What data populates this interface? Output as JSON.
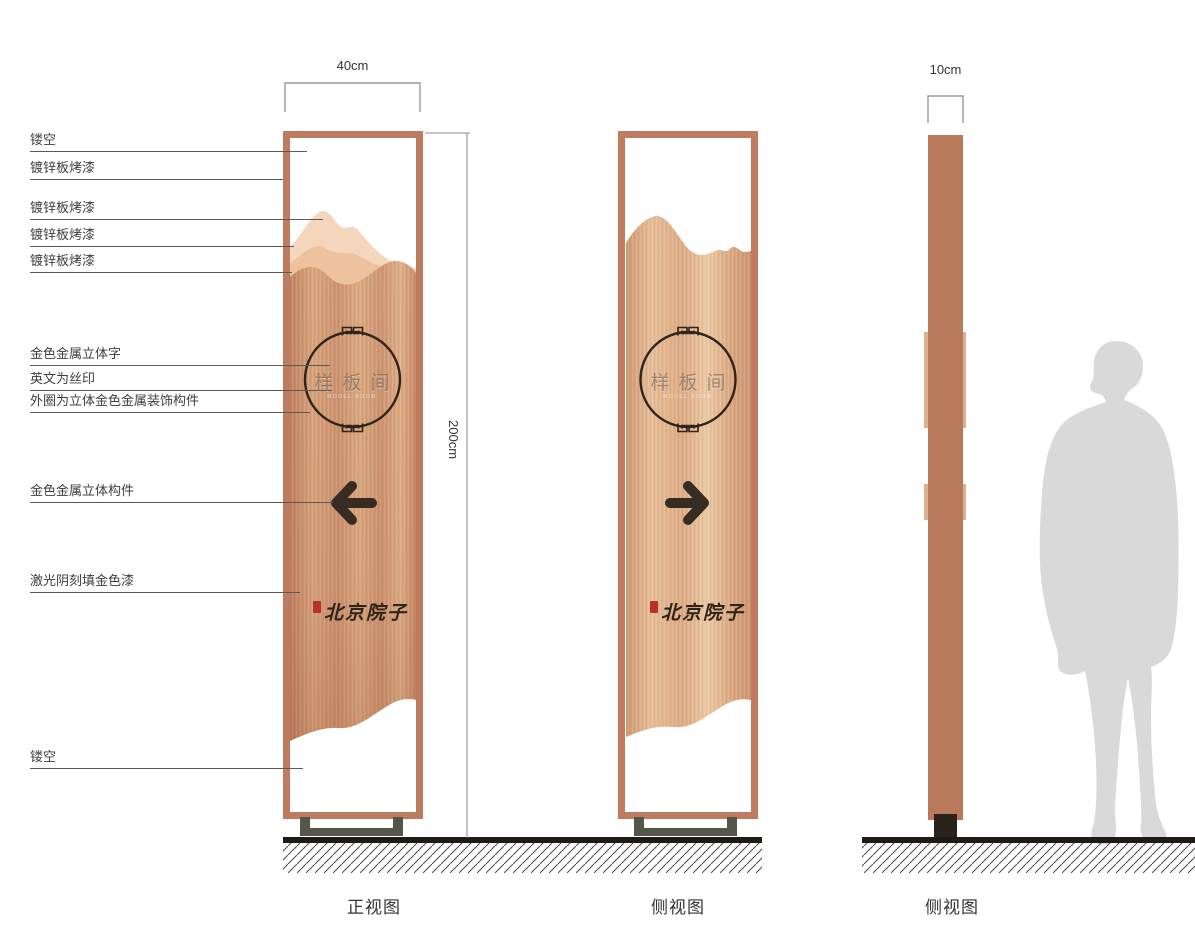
{
  "dimensions": {
    "front_width": "40cm",
    "height": "200cm",
    "side_width": "10cm"
  },
  "callouts": [
    "镂空",
    "镀锌板烤漆",
    "镀锌板烤漆",
    "镀锌板烤漆",
    "镀锌板烤漆",
    "金色金属立体字",
    "英文为丝印",
    "外圈为立体金色金属装饰构件",
    "金色金属立体构件",
    "激光阴刻填金色漆",
    "镂空"
  ],
  "sign": {
    "room_name": "样板间",
    "room_name_en": "MODEL ROOM",
    "brand_name": "北京院子"
  },
  "captions": {
    "front_view": "正视图",
    "side_view_1": "侧视图",
    "side_view_2": "侧视图"
  },
  "colors": {
    "frame": "#bd7b60",
    "copper": "#cf9772",
    "mountain_light": "#f4d6bc",
    "mountain_mid": "#eec29f",
    "ink": "#2e2419",
    "arrow_ink": "#372c22",
    "seal_red": "#b43324",
    "base_foot": "#55564a",
    "bar": "#b97a5c",
    "bar_tab": "#d8b290",
    "ground_ink": "#1e1a15",
    "silhouette": "#d9d9d9",
    "dim_line": "#9a9a9a",
    "label_ink": "#3d3d3d",
    "line_ink": "#5a5a5a"
  }
}
